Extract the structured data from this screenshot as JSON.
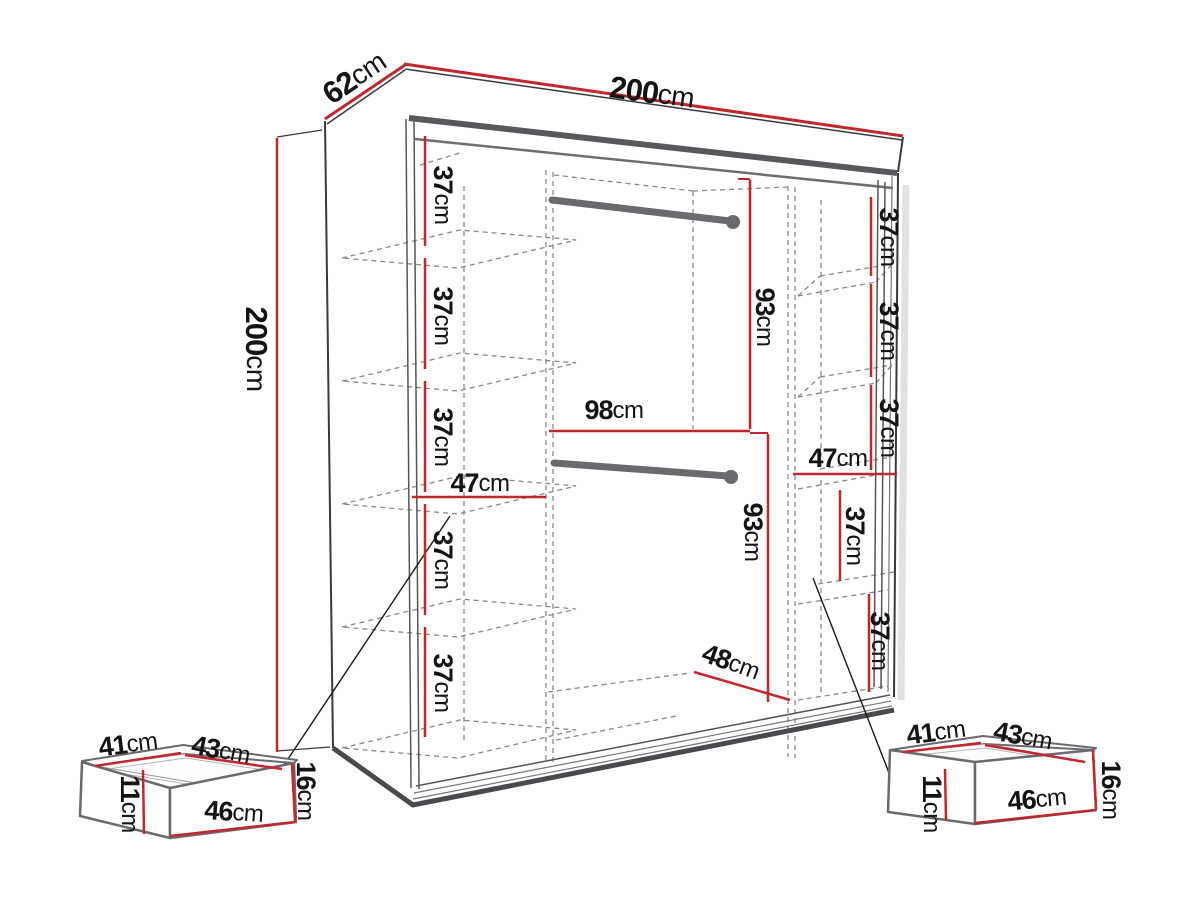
{
  "colors": {
    "red": "#c1272d",
    "frame_dark": "#3a3a3e",
    "frame_thick": "#58585c",
    "frame_mid": "#6e6e72",
    "wall": "#555558",
    "track": "#4a4a4e",
    "dash": "#8a8a8a",
    "shadow": "#dcdcdc",
    "pointer": "#1a1a1a",
    "drawer_edge": "#6a6a6e",
    "drawer_detail": "#9a9a9e",
    "rail": "#6a6a6e",
    "text": "#141414"
  },
  "wardrobe": {
    "width": {
      "v": "200",
      "u": "cm"
    },
    "depth": {
      "v": "62",
      "u": "cm"
    },
    "height": {
      "v": "200",
      "u": "cm"
    },
    "left_bay": {
      "gaps": [
        {
          "v": "37",
          "u": "cm"
        },
        {
          "v": "37",
          "u": "cm"
        },
        {
          "v": "37",
          "u": "cm"
        },
        {
          "v": "37",
          "u": "cm"
        },
        {
          "v": "37",
          "u": "cm"
        }
      ],
      "shelf_width": {
        "v": "47",
        "u": "cm"
      }
    },
    "middle_bay": {
      "upper_section_height": {
        "v": "93",
        "u": "cm"
      },
      "width": {
        "v": "98",
        "u": "cm"
      },
      "lower_section_height": {
        "v": "93",
        "u": "cm"
      },
      "floor_width": {
        "v": "48",
        "u": "cm"
      }
    },
    "right_bay": {
      "upper_gaps": [
        {
          "v": "37",
          "u": "cm"
        },
        {
          "v": "37",
          "u": "cm"
        },
        {
          "v": "37",
          "u": "cm"
        }
      ],
      "shelf_width": {
        "v": "47",
        "u": "cm"
      },
      "lower_gaps": [
        {
          "v": "37",
          "u": "cm"
        },
        {
          "v": "37",
          "u": "cm"
        }
      ]
    }
  },
  "left_drawer": {
    "top_depth": {
      "v": "41",
      "u": "cm"
    },
    "top_width": {
      "v": "43",
      "u": "cm"
    },
    "front_width": {
      "v": "46",
      "u": "cm"
    },
    "height": {
      "v": "16",
      "u": "cm"
    },
    "inner_height": {
      "v": "11",
      "u": "cm"
    }
  },
  "right_drawer": {
    "top_depth": {
      "v": "41",
      "u": "cm"
    },
    "top_width": {
      "v": "43",
      "u": "cm"
    },
    "front_width": {
      "v": "46",
      "u": "cm"
    },
    "height": {
      "v": "16",
      "u": "cm"
    },
    "inner_height": {
      "v": "11",
      "u": "cm"
    }
  }
}
